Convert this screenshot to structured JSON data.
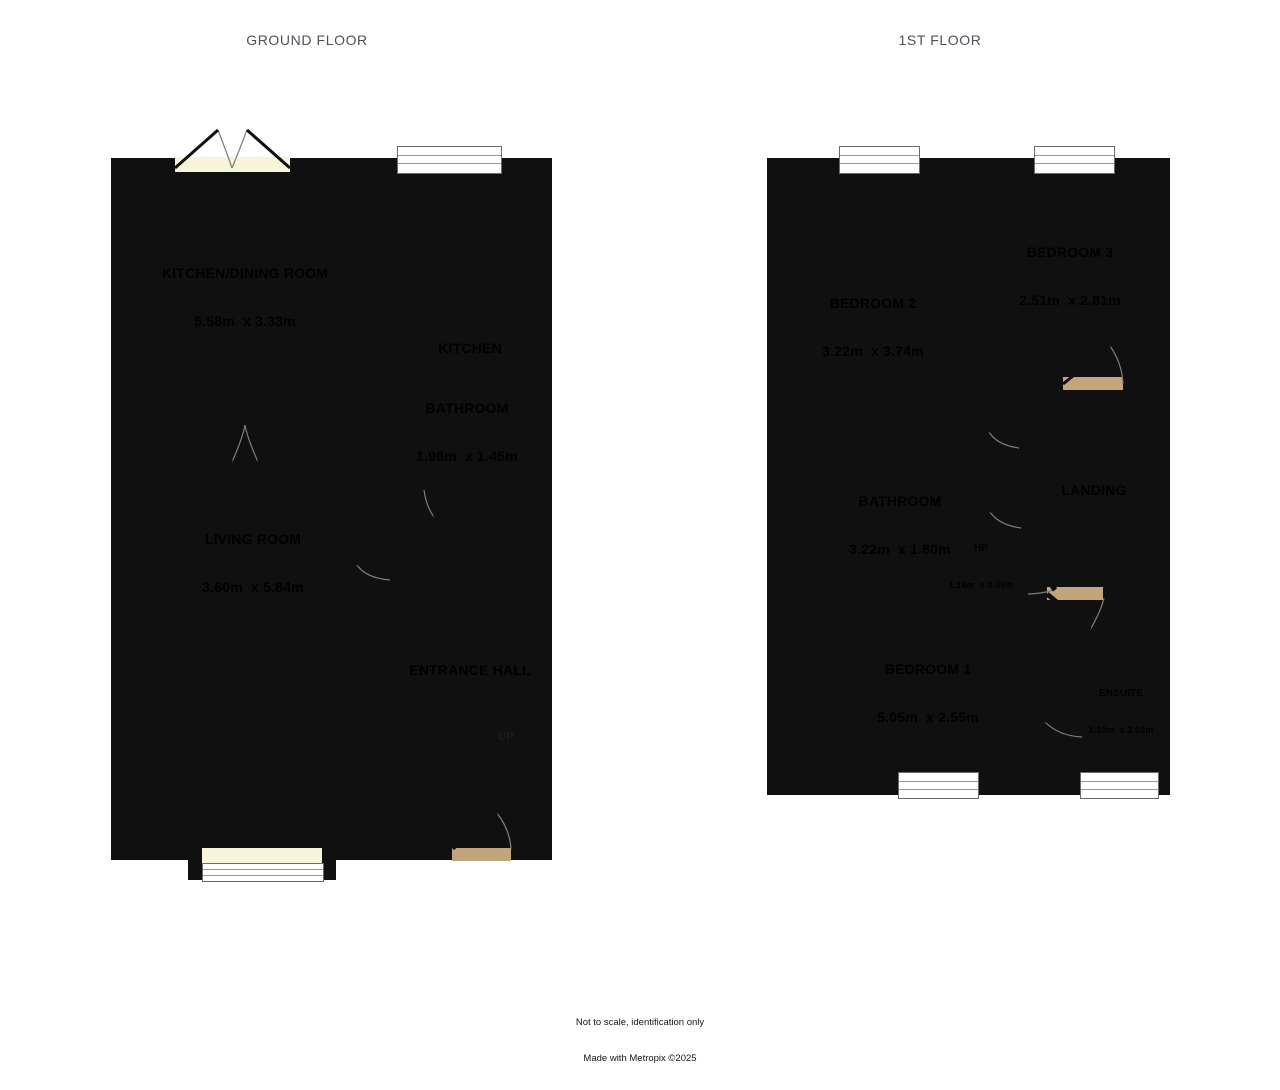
{
  "canvas": {
    "width": 1280,
    "height": 1090,
    "background": "#ffffff"
  },
  "footer": {
    "line1": "Not to scale, identification only",
    "line2": "Made with Metropix ©2025"
  },
  "floors": {
    "ground": {
      "title": "GROUND FLOOR",
      "rooms": {
        "kitchen_dining": {
          "name": "KITCHEN/DINING ROOM",
          "dims": "5.58m  x 3.33m"
        },
        "kitchen": {
          "name": "KITCHEN"
        },
        "bathroom": {
          "name": "BATHROOM",
          "dims": "1.98m  x 1.45m"
        },
        "living_room": {
          "name": "LIVING ROOM",
          "dims": "3.60m  x 5.84m"
        },
        "entrance_hall": {
          "name": "ENTRANCE HALL"
        },
        "stairs": {
          "direction_label": "UP"
        }
      }
    },
    "first": {
      "title": "1ST FLOOR",
      "rooms": {
        "bedroom2": {
          "name": "BEDROOM 2",
          "dims": "3.22m  x 3.74m"
        },
        "bedroom3": {
          "name": "BEDROOM 3",
          "dims": "2.51m  x 2.81m"
        },
        "landing": {
          "name": "LANDING"
        },
        "bathroom": {
          "name": "BATHROOM",
          "dims": "3.22m  x 1.80m"
        },
        "hot_press": {
          "name": "HP",
          "dims": "1.16m  x 0.69m"
        },
        "bedroom1": {
          "name": "BEDROOM 1",
          "dims": "5.05m  x 2.55m"
        },
        "ensuite": {
          "name": "ENSUITE",
          "dims": "1.10m  x 2.02m"
        }
      }
    }
  },
  "colors": {
    "wall": "#101010",
    "ground_room_fill": "#f8f4da",
    "first_room_fill": "#f4e1a1",
    "wet_room_fill": "#a9d4e2",
    "hall_landing_fill": "#c2a57d",
    "closet_fill": "#eeac82",
    "window_fill": "#ffffff",
    "title_text": "#505058",
    "label_text": "#000000"
  }
}
